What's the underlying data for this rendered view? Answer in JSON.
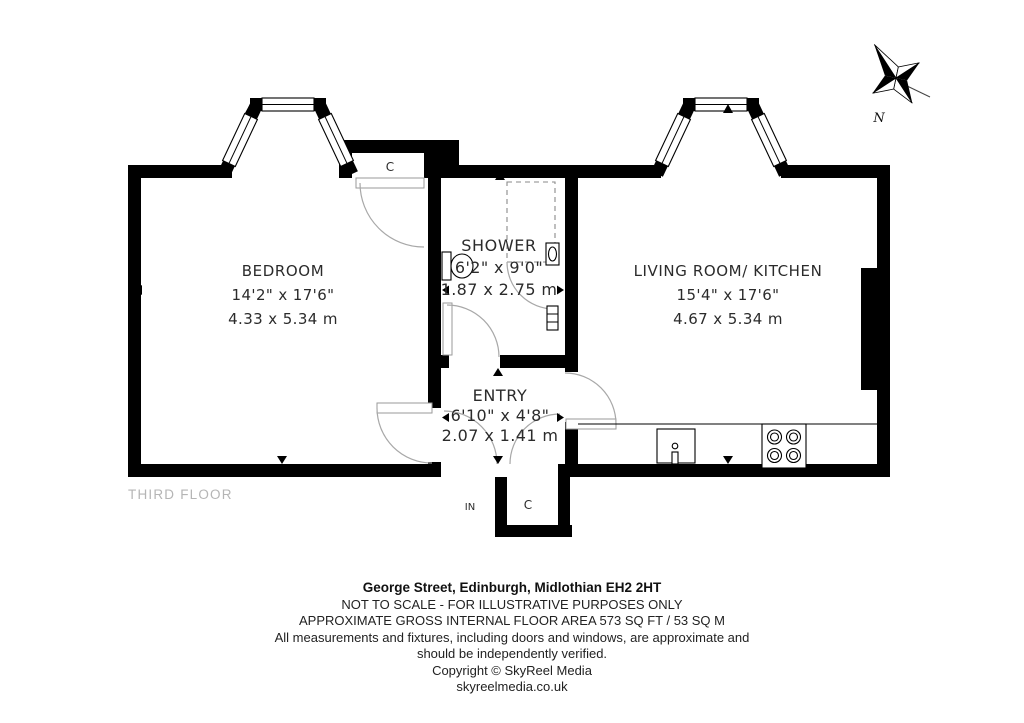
{
  "rooms": {
    "bedroom": {
      "name": "BEDROOM",
      "imperial": "14'2\" x 17'6\"",
      "metric": "4.33 x 5.34 m"
    },
    "shower": {
      "name": "SHOWER",
      "imperial": "6'2\" x 9'0\"",
      "metric": "1.87 x 2.75 m"
    },
    "entry": {
      "name": "ENTRY",
      "imperial": "6'10\" x 4'8\"",
      "metric": "2.07 x 1.41 m"
    },
    "living_kitchen": {
      "name": "LIVING ROOM/ KITCHEN",
      "imperial": "15'4\" x 17'6\"",
      "metric": "4.67 x 5.34 m"
    }
  },
  "labels": {
    "floor": "THIRD FLOOR",
    "entrance": "IN",
    "closet_top": "C",
    "closet_vestibule": "C",
    "compass_north": "N"
  },
  "footer": {
    "address": "George Street, Edinburgh, Midlothian EH2 2HT",
    "scale_note": "NOT TO SCALE - FOR ILLUSTRATIVE PURPOSES ONLY",
    "area_note": "APPROXIMATE GROSS INTERNAL FLOOR AREA 573 SQ FT / 53 SQ M",
    "disclaimer_line1": "All measurements and fixtures, including doors and windows, are approximate and",
    "disclaimer_line2": "should be independently verified.",
    "copyright": "Copyright © SkyReel Media",
    "website": "skyreelmedia.co.uk"
  },
  "colors": {
    "wall": "#000000",
    "room_text": "#2b2b2b",
    "floor_label_text": "#b5b5b5",
    "door_arc": "#a8a8a8",
    "background": "#ffffff"
  }
}
